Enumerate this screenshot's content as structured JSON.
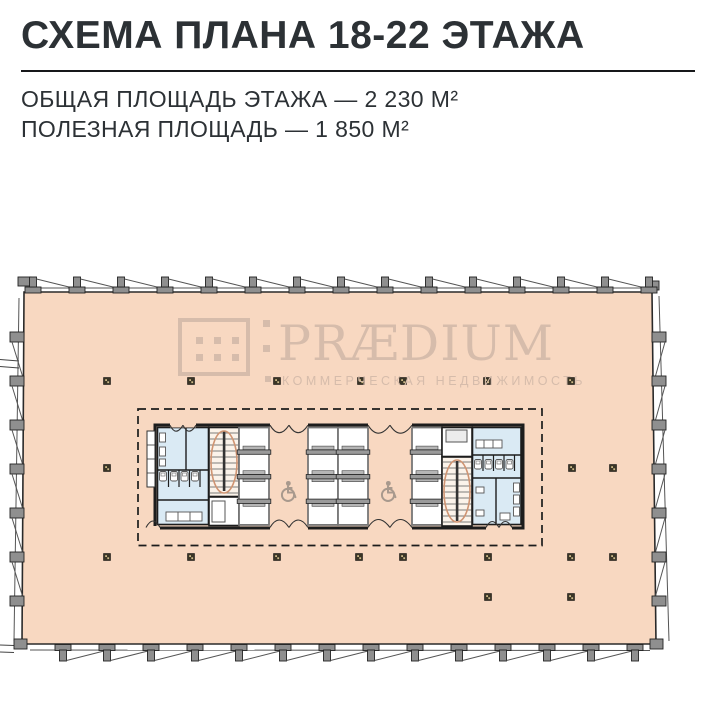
{
  "header": {
    "title": "СХЕМА ПЛАНА 18-22 ЭТАЖА",
    "area_line1": "ОБЩАЯ ПЛОЩАДЬ ЭТАЖА — 2 230 М²",
    "area_line2": "ПОЛЕЗНАЯ ПЛОЩАДЬ — 1 850 М²"
  },
  "watermark": {
    "brand": "PRÆDIUM",
    "tagline": "КОММЕРЧЕСКАЯ НЕДВИЖИМОСТЬ"
  },
  "plan": {
    "icons": {
      "accessible": "wheelchair-icon"
    },
    "colors": {
      "floor_fill": "#f8d8c1",
      "wall": "#1d1d1d",
      "facade_gray": "#8f8f8f",
      "room_blue": "#daeaf4",
      "stair_fill": "#fbf3ea",
      "stair_accent": "#cf9472",
      "column_dark": "#3a3526",
      "column_speck": "#cdb987",
      "shaft_gray": "#9a9a9a",
      "icon_gray": "#a8998d",
      "watermark": "#d6bcab",
      "text": "#2c3135"
    }
  }
}
